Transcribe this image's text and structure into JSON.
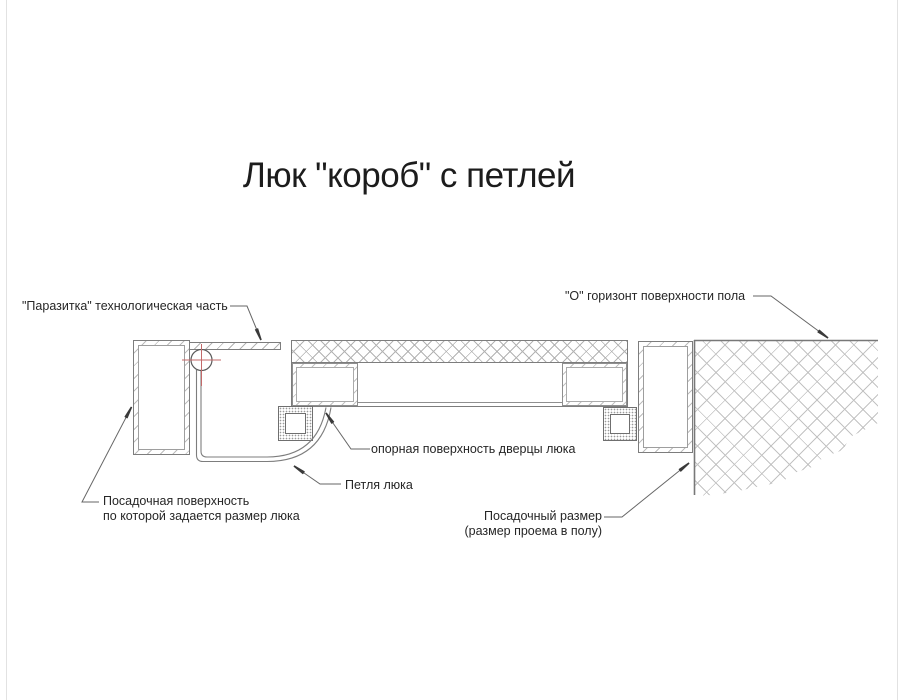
{
  "title": "Люк \"короб\" с петлей",
  "labels": {
    "parasitka": "\"Паразитка\" технологическая часть",
    "floor_horizon": "\"О\" горизонт поверхности пола",
    "support_surface": "опорная поверхность дверцы люка",
    "hinge": "Петля люка",
    "seat_surface_line1": "Посадочная поверхность",
    "seat_surface_line2": "по которой задается размер люка",
    "seat_size_line1": "Посадочный размер",
    "seat_size_line2": "(размер проема в полу)"
  },
  "colors": {
    "drawing_line": "#7d7d7d",
    "leader_line": "#666666",
    "arrowhead": "#3a3a3a",
    "hatch": "#b6b6b6",
    "text": "#262626",
    "center_mark_red": "#c36a6a"
  }
}
